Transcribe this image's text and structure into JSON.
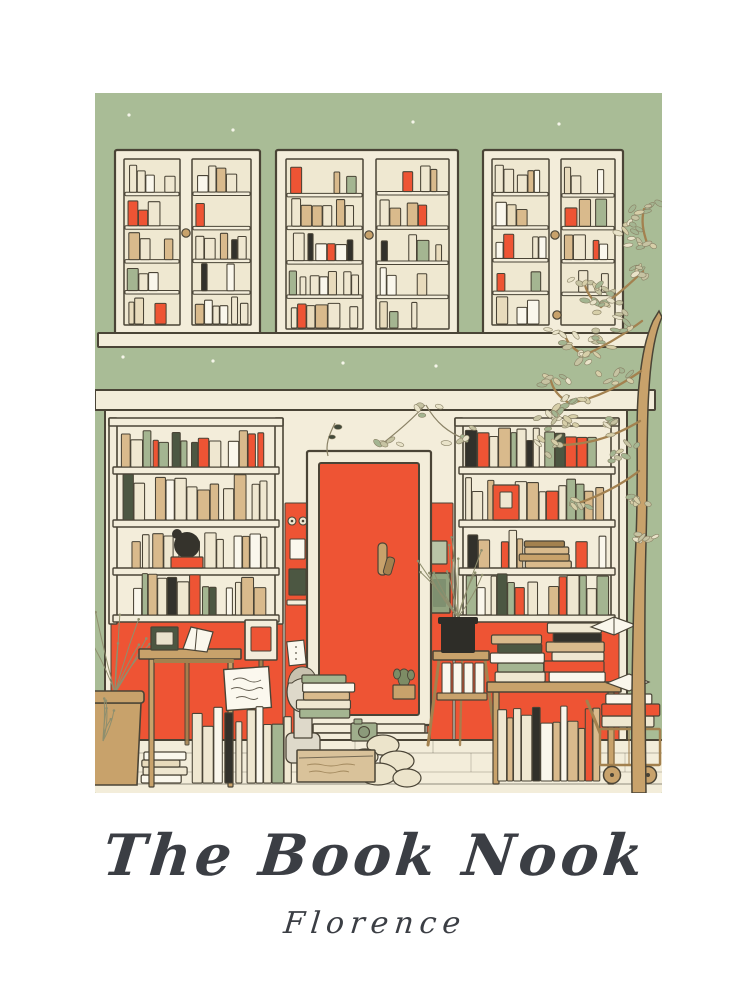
{
  "poster": {
    "title": "The Book Nook",
    "subtitle": "Florence",
    "alt": "Illustrated bookshop facade: sage green wall, three cabinet windows full of books, red front door, display bookshelves and book stacks on the sidewalk, slender tree on the right"
  },
  "colors": {
    "page_bg": "#ffffff",
    "ink": "#3b3e44",
    "outline": "#4a4436",
    "facade_green": "#a9bc96",
    "cream": "#f3edda",
    "pane": "#efe8d1",
    "door_red": "#ee5434",
    "wood_tan": "#c8a26b",
    "wood_dark": "#a3814f",
    "book_cream": "#efe7d0",
    "book_white": "#faf7ec",
    "book_tan": "#d9ba8c",
    "book_sage": "#a4b591",
    "book_orange": "#ee5434",
    "book_dark": "#4c5742",
    "book_black": "#32312b",
    "bust_stone": "#ded9ca",
    "leaf_olive": "#c6c3a2",
    "pot_black": "#2e2d28",
    "sign_white": "#fbf8ee",
    "cardboard": "#d9c29a",
    "mailbox_sage": "#93a37f",
    "letter_sage": "#b9c4a6"
  }
}
